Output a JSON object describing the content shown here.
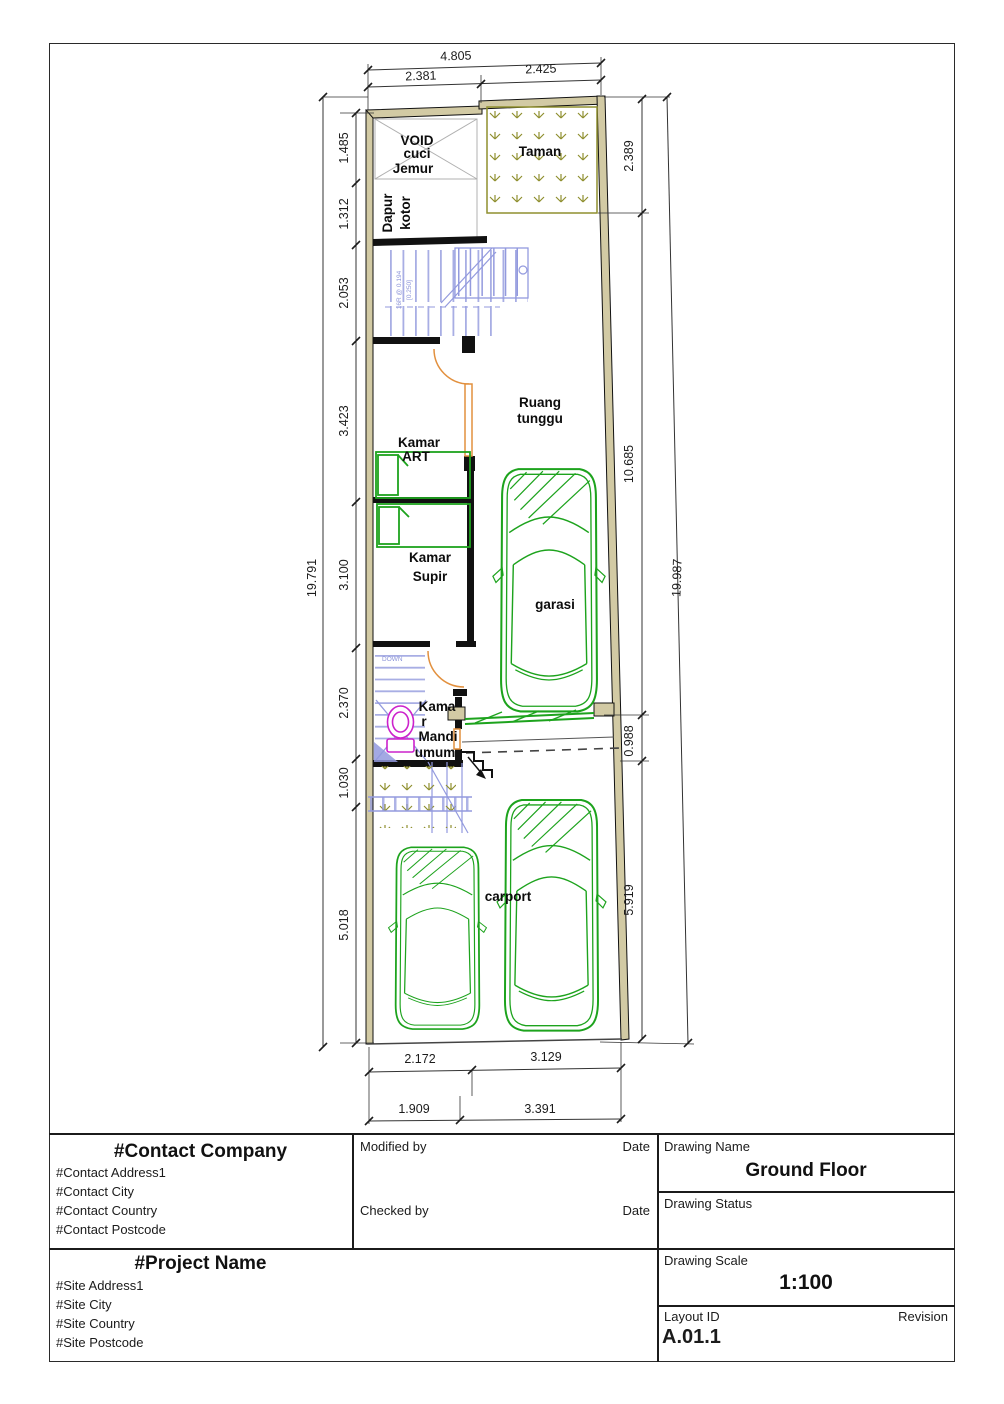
{
  "plan": {
    "rooms": {
      "void1": "VOID",
      "void2": "cuci",
      "void3": "Jemur",
      "taman": "Taman",
      "dapur1": "Dapur",
      "dapur2": "kotor",
      "ruang1": "Ruang",
      "ruang2": "tunggu",
      "art1": "Kamar",
      "art2": "ART",
      "supir1": "Kamar",
      "supir2": "Supir",
      "garasi": "garasi",
      "mandi1": "Kama",
      "mandi2": "r",
      "mandi3": "Mandi",
      "mandi4": "umum",
      "carport": "carport"
    },
    "annotations": {
      "down": "DOWN",
      "stair_note1": "16R @ 0.194",
      "stair_note2": "[0.250]"
    },
    "dims": {
      "top_total": "4.805",
      "top_segments": [
        "2.381",
        "2.425"
      ],
      "left_total": "19.791",
      "left_segments": [
        "1.485",
        "1.312",
        "2.053",
        "3.423",
        "3.100",
        "2.370",
        "1.030",
        "5.018"
      ],
      "right_total": "19.987",
      "right_segments": [
        "2.389",
        "10.685",
        "0.988",
        "5.919"
      ],
      "bottom_row1": [
        "2.172",
        "3.129"
      ],
      "bottom_row2": [
        "1.909",
        "3.391"
      ]
    }
  },
  "titleblock": {
    "contact": {
      "company": "#Contact Company",
      "address1": "#Contact Address1",
      "city": "#Contact City",
      "country": "#Contact Country",
      "postcode": "#Contact Postcode"
    },
    "project": {
      "name": "#Project Name",
      "address1": "#Site Address1",
      "city": "#Site City",
      "country": "#Site Country",
      "postcode": "#Site Postcode"
    },
    "signoff": {
      "modified_by_label": "Modified by",
      "modified_date_label": "Date",
      "checked_by_label": "Checked by",
      "checked_date_label": "Date"
    },
    "drawing": {
      "name_label": "Drawing Name",
      "name_value": "Ground Floor",
      "status_label": "Drawing Status",
      "scale_label": "Drawing Scale",
      "scale_value": "1:100",
      "layout_id_label": "Layout ID",
      "layout_id_value": "A.01.1",
      "revision_label": "Revision"
    }
  },
  "colors": {
    "wall_fill": "#d2caa4",
    "stair_blue": "#939ade",
    "door_orange": "#e2903e",
    "furniture_green": "#1da31d",
    "toilet_magenta": "#cc22cc",
    "taman_olive": "#8f8f2f",
    "dimension_black": "#1c1c1c"
  }
}
